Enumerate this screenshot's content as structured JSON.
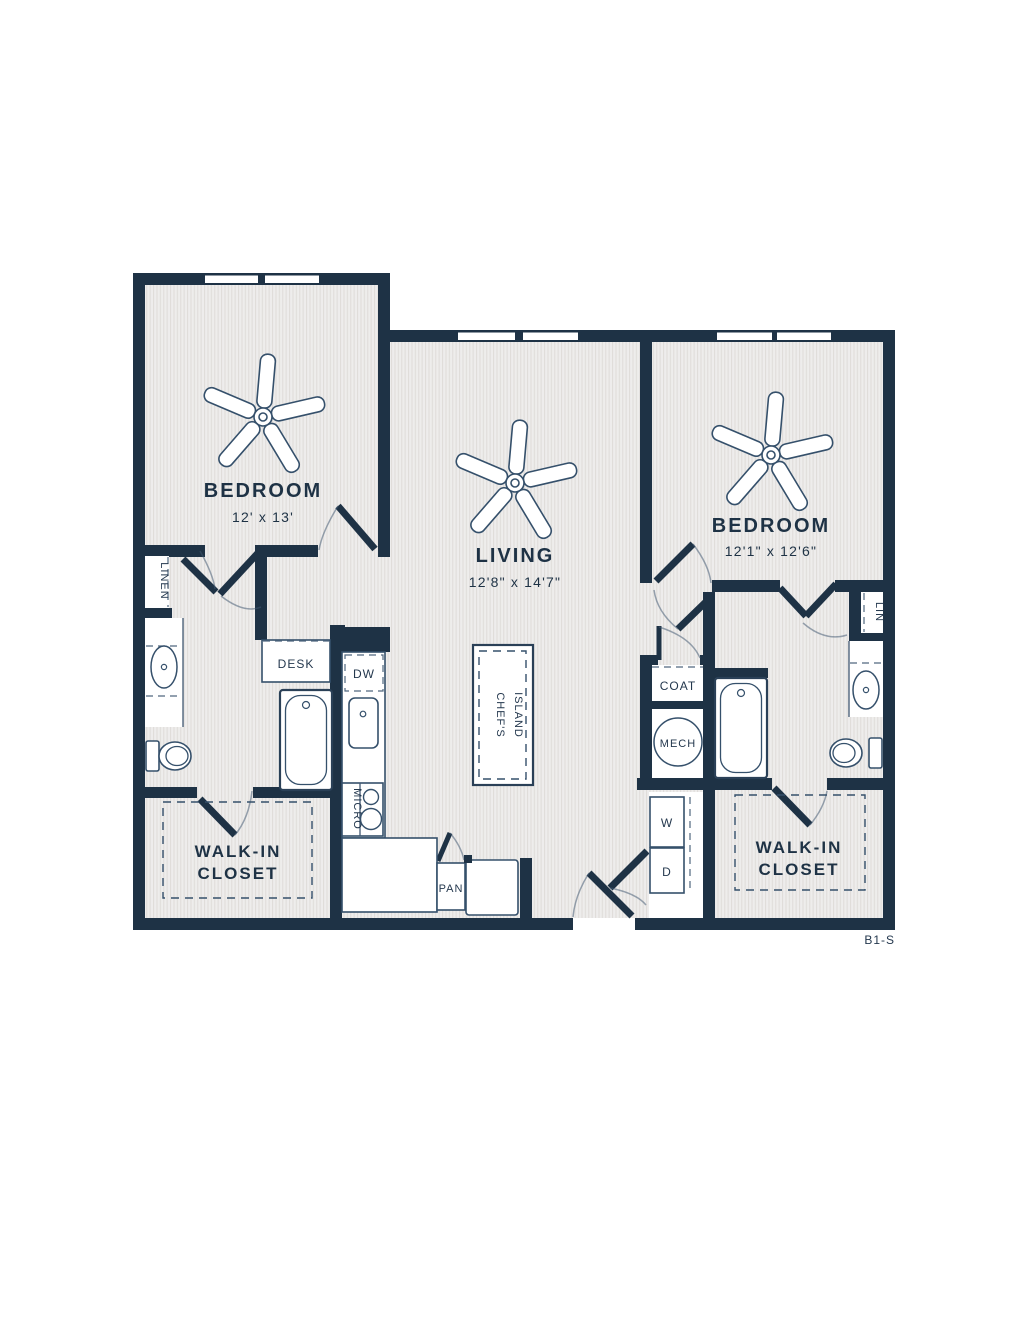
{
  "plan": {
    "unit_code": "B1-S",
    "colors": {
      "wall": "#1e3245",
      "floor_bg": "#eeedec",
      "floor_line": "#e0ddda"
    },
    "rooms": {
      "bedroom_left": {
        "name": "BEDROOM",
        "dims": "12' x 13'"
      },
      "living": {
        "name": "LIVING",
        "dims": "12'8\" x 14'7\""
      },
      "bedroom_right": {
        "name": "BEDROOM",
        "dims": "12'1\" x 12'6\""
      },
      "walk_in_closet_left": {
        "line1": "WALK-IN",
        "line2": "CLOSET"
      },
      "walk_in_closet_right": {
        "line1": "WALK-IN",
        "line2": "CLOSET"
      }
    },
    "labels": {
      "linen": "LINEN",
      "desk": "DESK",
      "dw": "DW",
      "micro": "MICRO",
      "pan": "PAN",
      "island_line1": "CHEF'S",
      "island_line2": "ISLAND",
      "coat": "COAT",
      "mech": "MECH",
      "washer": "W",
      "dryer": "D",
      "lin": "LIN"
    }
  }
}
